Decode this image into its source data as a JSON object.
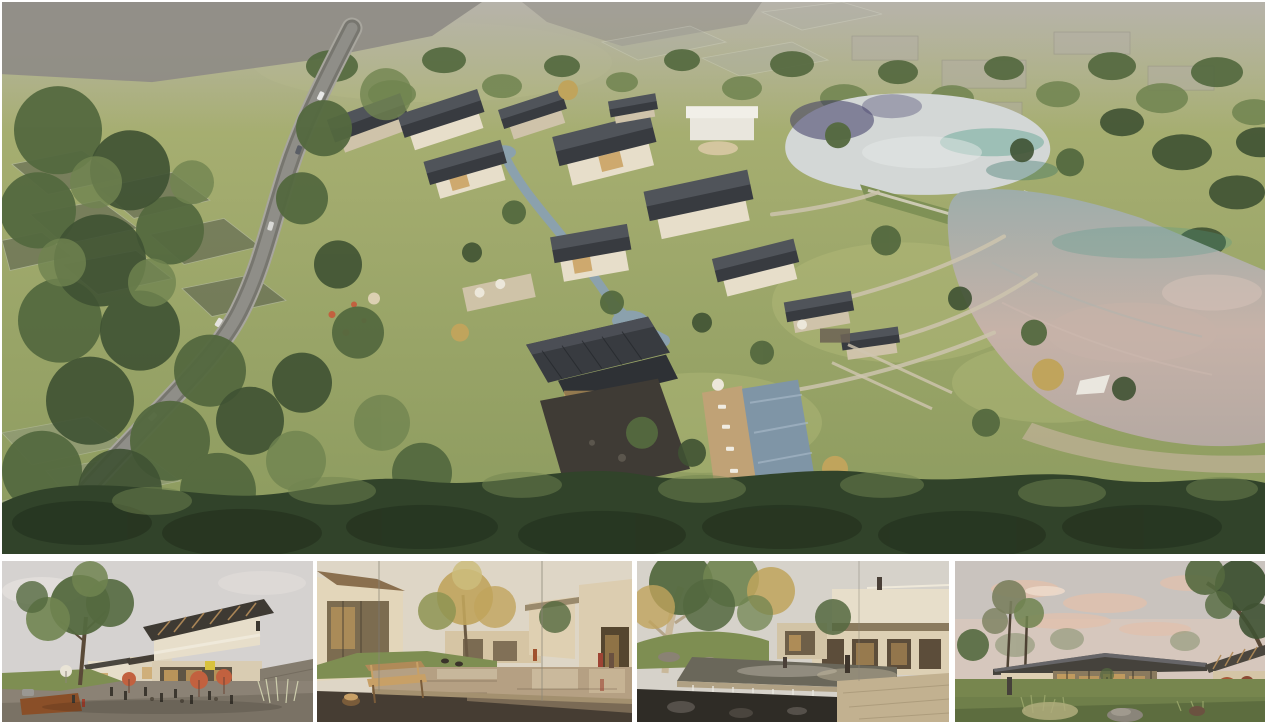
{
  "board": {
    "title": "Architectural rendering presentation board",
    "alt": "Board with one large aerial rendering of a lakeside village resort and four street-level renderings below",
    "image_count": 5
  },
  "hero": {
    "name": "aerial-site-render",
    "alt": "Aerial view of a village resort beside two lakes",
    "description": "Bird's-eye rendering of a resort village: beige houses with dark pitched roofs clustered around a stream, stone courtyard and swimming pool; a curving grey road through woodland on the left; ghosted translucent field and roof plots; meadows with footpaths leading to an upper pond and a large lake reflecting a pink evening sky, separated by a grass causeway; dense tree band across the foreground."
  },
  "thumbnails": [
    {
      "name": "plaza-render",
      "alt": "Village plaza with cafe terraces",
      "description": "Street-level view of the central plaza at dusk: coral cafe umbrellas, people at tables, a two-storey building with a timber-lined canopy roof and glowing shopfronts, a large tree and corten planter on the left."
    },
    {
      "name": "pond-bench-render",
      "alt": "Courtyard reflecting pond with wooden bench",
      "description": "Warm courtyard scene: a slatted wooden bench and carved stump stool on a dark stone deck facing a reflecting pond, a golden tree and stucco guesthouses, two visitors walking on the right."
    },
    {
      "name": "waterfall-courtyard-render",
      "alt": "Garden pond with waterfall weir",
      "description": "Garden courtyard with a stone-edged pond spilling over a weir into a dark lower pool, a mature plane tree overhead, cantilevered guest wings with a figure on the roof terrace and a travertine deck."
    },
    {
      "name": "evening-pavilion-render",
      "alt": "Glass pavilion at dusk on a meadow",
      "description": "Evening view of a single-storey pavilion with a dark standing-seam roof and full-height glazing glowing from within, a timber-rafter wing and red maple at right, meadow grasses, boulders and a stump in the foreground under a pink-clouded sky."
    }
  ],
  "palette": {
    "canvas_bg": "#ffffff",
    "grass_light": "#b3bb7b",
    "grass_dark": "#7e8e52",
    "tree_dark": "#3f5233",
    "tree_mid": "#54693f",
    "tree_light": "#708450",
    "tree_band": "#31432a",
    "ghost_gray": "#4f544b",
    "road_gray": "#8f8e88",
    "wall_beige": "#e7deca",
    "wall_shade": "#cfc3aa",
    "roof_dark": "#383b40",
    "roof_light": "#50545a",
    "stone_dark": "#3f3b35",
    "pool_blue": "#7f95a6",
    "stream_blue": "#8ba1ad",
    "deck_wood": "#c0a276",
    "path_beige": "#cdc4ae",
    "umbrella_coral": "#c2613f",
    "window_glow": "#c9a05e",
    "autumn_gold": "#c0a45c",
    "cloud_pink": "#e2c0ab",
    "lake_pale": "#d3d7d6",
    "lake_teal": "#4e9a88",
    "lake_reflection": "#3e3a66",
    "lake_pink": "#c6b2a8",
    "pond_warm": "#b5a083",
    "sky_pale": "#d5d2d0",
    "sky_warm": "#ded6c6"
  }
}
